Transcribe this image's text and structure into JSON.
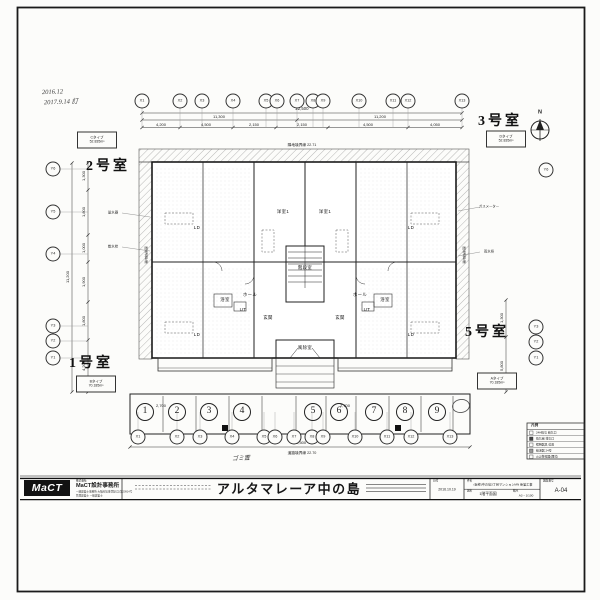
{
  "sheet": {
    "bg": "#fcfcfa",
    "ink": "#222222"
  },
  "handwritten": {
    "date1": "2016.12",
    "date2": "2017.9.14 訂",
    "note": "ゴミ置"
  },
  "compass": {
    "label": "N"
  },
  "units": {
    "room1": {
      "label": "1号室",
      "type": "Bタイプ",
      "area": "70.185m²"
    },
    "room2": {
      "label": "2号室",
      "type": "Cタイプ",
      "area": "52.835m²"
    },
    "room3": {
      "label": "3号室",
      "type": "Dタイプ",
      "area": "52.835m²"
    },
    "room5": {
      "label": "5号室",
      "type": "Aタイプ",
      "area": "70.185m²"
    }
  },
  "grid": {
    "x_labels": [
      "X1",
      "X2",
      "X3",
      "X4",
      "X5",
      "X6",
      "X7",
      "X8",
      "X9",
      "X10",
      "X11",
      "X12",
      "X13"
    ],
    "y_left": [
      "Y6",
      "Y5",
      "Y4",
      "Y3",
      "Y2",
      "Y1"
    ],
    "y_right": [
      "Y6",
      "Y3",
      "Y2",
      "Y1"
    ]
  },
  "dims": {
    "top": {
      "total": "22,500",
      "left_half": "11,300",
      "right_half": "11,200",
      "segments": [
        "4,200",
        "4,500",
        "2,150",
        "2,150",
        "4,500",
        "4,050"
      ]
    },
    "left": {
      "total": "11,200",
      "segments": [
        "1,300",
        "1,800",
        "1,000",
        "1,900",
        "1,800",
        "4,200"
      ]
    },
    "right": {
      "segments": [
        "1,300",
        "5,800"
      ]
    },
    "bottom": {
      "total": "22,500"
    }
  },
  "boundaries": {
    "top": "隣地境界線 22.71",
    "bottom": "道路境界線 22.70",
    "left": "隣地境界線",
    "right": "隣地境界線"
  },
  "parking": {
    "numbers": [
      "1",
      "2",
      "3",
      "4",
      "5",
      "6",
      "7",
      "8",
      "9"
    ],
    "stall_dim": "2,700"
  },
  "plan": {
    "labels": [
      "LD",
      "洋室1",
      "洋室1",
      "LD",
      "ホール",
      "階段室",
      "ホール",
      "浴室",
      "UT",
      "UT",
      "浴室",
      "玄関",
      "玄関",
      "風除室",
      "LD",
      "LD"
    ]
  },
  "notes": [
    "量水器",
    "散水栓",
    "ガスメーター",
    "雨水枡"
  ],
  "legend": {
    "title": "凡例",
    "rows": [
      "24H換気 給気口",
      "換気扇 排気口",
      "照明器具 位置",
      "給湯器 24号",
      "火災警報器(煙式)"
    ]
  },
  "title_block": {
    "logo": "MaCT",
    "company_prefix": "株式会社",
    "company": "MaCT設計事務所",
    "license1": "一級建築士事務所 大阪府知事登録(ロ)第20914号",
    "license2": "管理建築士 一級建築士",
    "project_title": "アルタマレーア中の島",
    "date_label": "日付",
    "date": "2016.10.19",
    "name_label": "件名",
    "project_name": "(仮称)中の島3丁目マンションMN 新築工事",
    "sheet_label": "図名",
    "sheet_name": "1階平面図",
    "scale_label": "縮尺",
    "scale": "A3・1/100",
    "no_label": "図面番号",
    "sheet_no": "A-04"
  }
}
